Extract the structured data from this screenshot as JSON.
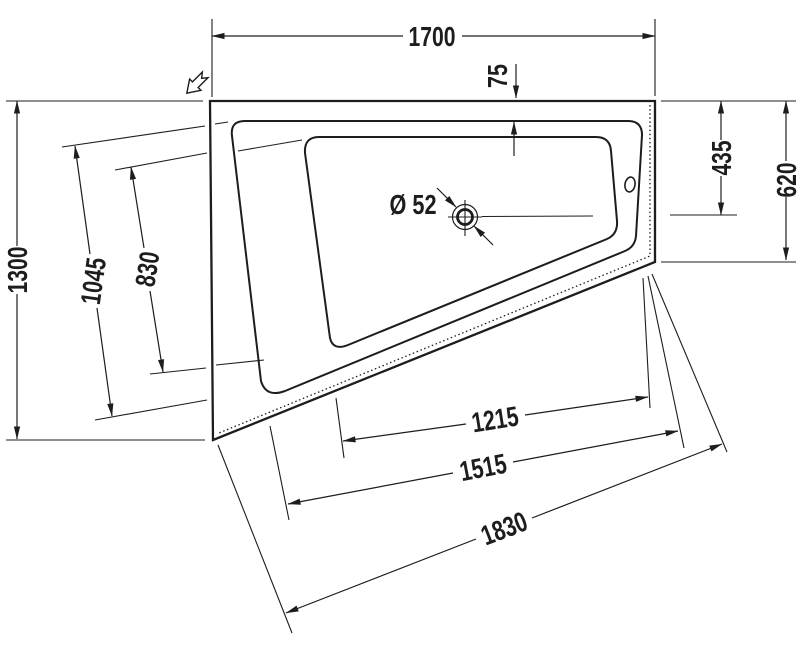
{
  "drawing": {
    "type": "technical-drawing",
    "subject": "corner bathtub top view with dimensions",
    "colors": {
      "line": "#1d1d1b",
      "background": "#ffffff"
    },
    "dimensions": {
      "top_width": "1700",
      "rim_inset_top": "75",
      "top_to_drain": "435",
      "right_side_depth": "620",
      "left_height": "1300",
      "rim_length_left": "1045",
      "basin_length_left": "830",
      "drain_diameter": "Ø 52",
      "bottom_length_inner": "1215",
      "bottom_length_middle": "1515",
      "bottom_length_outer": "1830"
    },
    "icons": {
      "direction_arrow": "view-direction-arrow"
    }
  }
}
